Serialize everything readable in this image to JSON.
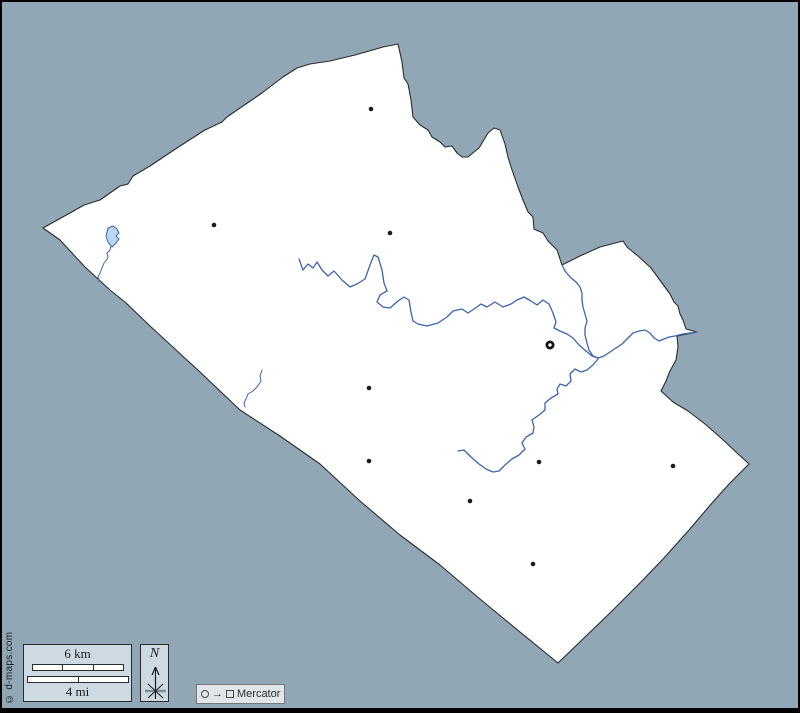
{
  "canvas": {
    "width": 800,
    "height": 713,
    "background": "#92a7b6",
    "frame_color": "#000000"
  },
  "map": {
    "county_fill": "#ffffff",
    "border_color": "#2b2b2b",
    "river_color": "#3c63ae",
    "lake_fill": "#bcd6ee",
    "marker_color": "#1c1c1c",
    "outline_path": "M 43,228 L 70,213 L 84,205 L 100,200 L 120,186 L 128,184 L 133,176 L 150,166 L 180,146 L 205,130 L 222,122 L 227,117 L 240,108 L 262,93 L 283,77 L 297,68 L 310,64 L 330,61 L 355,55 L 383,47 L 398,44 L 402,62 L 404,78 L 408,84 L 411,100 L 413,117 L 420,125 L 428,130 L 432,137 L 440,142 L 445,147 L 452,146 L 457,153 L 462,157 L 468,157 L 474,152 L 479,148 L 488,133 L 494,128 L 500,130 L 505,144 L 508,157 L 511,167 L 518,187 L 523,200 L 528,212 L 533,217 L 534,229 L 543,233 L 548,241 L 557,250 L 562,265 L 580,256 L 600,247 L 623,241 L 627,247 L 633,252 L 638,256 L 651,268 L 662,283 L 670,294 L 674,302 L 678,306 L 680,314 L 683,320 L 686,329 L 697,332 L 677,336 L 678,347 L 676,360 L 670,371 L 666,381 L 661,391 L 673,402 L 688,411 L 705,424 L 721,438 L 736,452 L 749,464 L 730,483 L 712,503 L 689,530 L 664,558 L 639,584 L 612,611 L 584,638 L 558,663 L 520,632 L 480,599 L 440,565 L 400,535 L 360,501 L 320,464 L 280,436 L 240,410 L 200,372 L 150,326 L 125,302 L 110,290 L 98,279 L 85,267 L 60,240 Z",
    "rivers": [
      {
        "name": "main-river",
        "path": "M 299,259 L 303,270 L 308,264 L 313,268 L 317,262 L 322,270 L 328,276 L 334,271 L 342,280 L 350,287 L 357,284 L 365,279 L 370,265 L 374,255 L 378,257 L 382,270 L 384,283 L 387,291 L 380,295 L 377,302 L 383,307 L 390,308 L 398,301 L 404,297 L 409,300 L 411,312 L 413,321 L 418,324 L 427,326 L 438,323 L 447,317 L 453,311 L 462,309 L 468,313 L 474,309 L 481,304 L 487,307 L 495,302 L 503,307 L 511,304 L 517,300 L 524,297 L 531,301 L 537,305 L 543,300 L 549,304 L 553,313 L 556,322 L 554,328 L 560,331 L 567,334 L 573,338 L 579,345 L 586,351 L 592,356 L 598,358"
      },
      {
        "name": "north-tributary",
        "path": "M 562,265 L 565,271 L 570,277 L 576,282 L 580,287 L 582,293 L 582,300 L 583,307 L 585,314 L 587,321 L 585,328 L 585,335 L 587,343 L 589,350 L 593,356 L 598,358"
      },
      {
        "name": "east-outlet",
        "path": "M 598,358 L 604,356 L 610,352 L 616,348 L 622,344 L 627,339 L 633,333 L 639,331 L 645,330 L 650,333 L 654,338 L 659,341 L 664,339 L 669,337 L 675,336 L 683,334 L 690,333 L 697,332"
      },
      {
        "name": "south-tributary",
        "path": "M 598,359 L 593,365 L 587,370 L 581,372 L 575,369 L 570,374 L 571,381 L 566,386 L 560,384 L 557,389 L 558,394 L 551,398 L 545,403 L 545,410 L 539,415 L 532,420 L 534,427 L 533,433 L 526,437 L 522,443 L 525,449 L 519,455 L 512,459 L 505,465 L 499,471 L 493,472 L 486,469 L 479,464 L 471,457 L 464,450 L 458,451"
      },
      {
        "name": "west-stream",
        "path": "M 111,246 L 110,250 L 107,253 L 108,258 L 104,263 L 102,268 L 100,273 L 98,277 L 99,281"
      },
      {
        "name": "southwest-stream",
        "path": "M 262,370 L 260,376 L 261,381 L 257,387 L 253,391 L 248,394 L 246,399 L 244,403 L 245,407"
      }
    ],
    "lake_path": "M 108,228 L 113,226 L 117,229 L 119,233 L 116,236 L 119,239 L 116,243 L 112,247 L 108,242 L 106,236 Z",
    "towns": [
      {
        "x": 371,
        "y": 109
      },
      {
        "x": 214,
        "y": 225
      },
      {
        "x": 390,
        "y": 233
      },
      {
        "x": 369,
        "y": 388
      },
      {
        "x": 369,
        "y": 461
      },
      {
        "x": 539,
        "y": 462
      },
      {
        "x": 673,
        "y": 466
      },
      {
        "x": 470,
        "y": 501
      },
      {
        "x": 533,
        "y": 564
      }
    ],
    "county_seat": {
      "x": 550,
      "y": 345
    }
  },
  "legend": {
    "scale_bar": {
      "km_label": "6 km",
      "mi_label": "4 mi"
    },
    "compass": {
      "north_label": "N"
    },
    "projection": {
      "arrow": "→",
      "label": "Mercator"
    },
    "copyright": "© d-maps.com"
  }
}
